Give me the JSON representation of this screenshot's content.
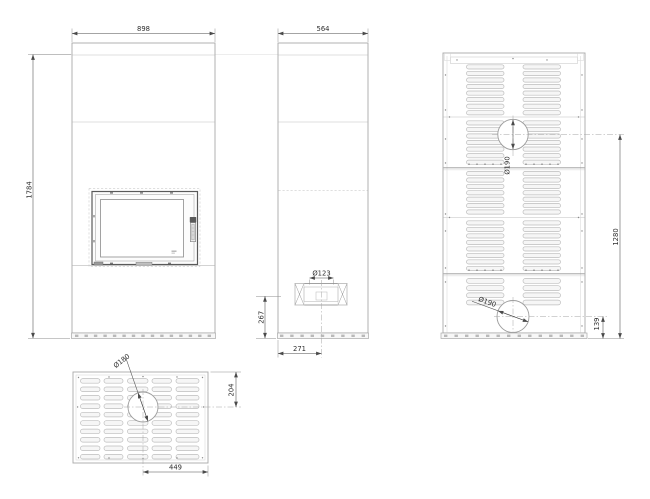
{
  "colors": {
    "background": "#ffffff",
    "outline": "#a8a8a8",
    "inner": "#d4d4d4",
    "faint": "#dcdcdc",
    "slot": "#bdbdbd",
    "centerline": "#a6a6a6",
    "dimension": "#4a4a4a",
    "text": "#2e2e2e"
  },
  "drawing": {
    "front_view": {
      "width": "898",
      "height": "1784"
    },
    "side_view": {
      "depth": "564",
      "intake_diameter": "Ø123",
      "intake_center_height": "267",
      "intake_center_offset": "271"
    },
    "rear_view": {
      "top_outlet_diameter": "Ø190",
      "outlet_span_height": "1280",
      "bottom_outlet_height": "139",
      "bottom_outlet_diameter": "Ø190"
    },
    "top_view": {
      "outlet_diameter": "Ø180",
      "outlet_center_from_edge": "204",
      "outlet_center_offset": "449"
    }
  }
}
